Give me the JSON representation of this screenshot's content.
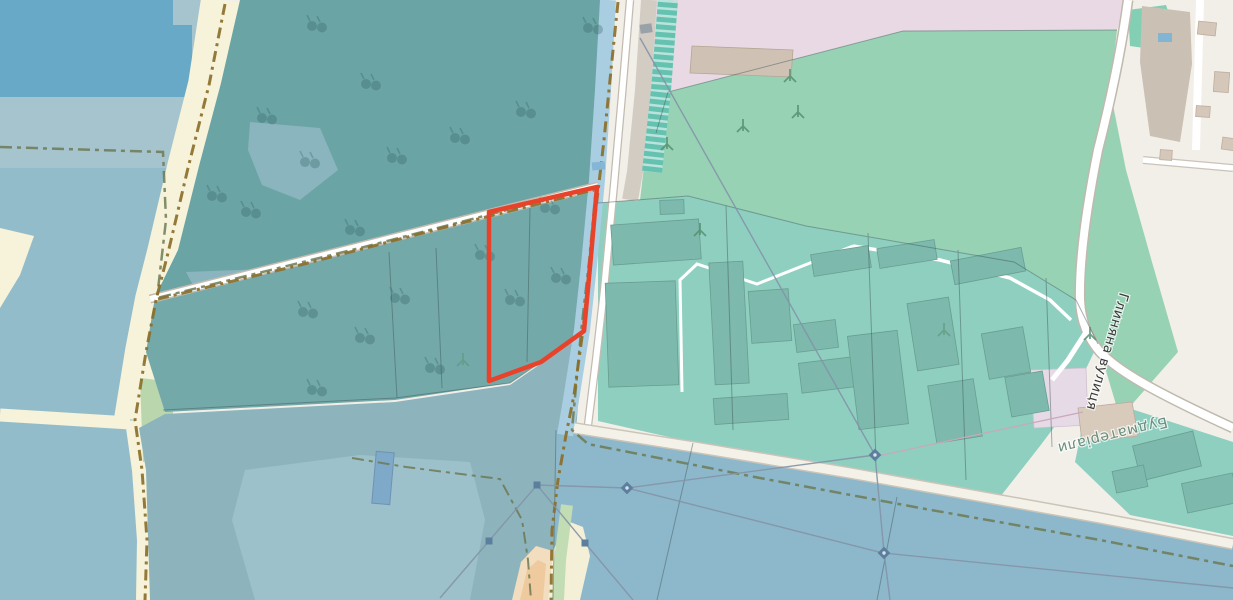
{
  "map": {
    "description": "openstreetmap-style rendering, rotated 180 degrees, with selected land parcel highlighted",
    "labels": {
      "street": "Глиняна вулиця",
      "landuse": "Будматеріали"
    },
    "colors": {
      "background": "#f2efe9",
      "water_dark": "#67a9c7",
      "water": "#93bcca",
      "water_band": "#a6c4ce",
      "water_bottom": "#8db8cb",
      "stream": "#a9cee1",
      "farmland": "#f6f3da",
      "forest": "#6ba4a4",
      "forest_parcels": "#74a9a9",
      "meadow_teal": "#8db4bd",
      "grass": "#97d2b4",
      "industrial_teal": "#8ecfc0",
      "building_teal": "#7db9ac",
      "building_gray": "#cfc2b4",
      "industrial_pink": "#e9d9e5",
      "brownfield": "#cbc0b4",
      "road_fill": "#ffffff",
      "road_casing": "#c2bcb0",
      "track": "#8a6d28",
      "boundary": "#6d7a55",
      "selection": "#e8432a",
      "sand": "#f2ddbe",
      "pale_green": "#b9d6ad",
      "street_label": "#3b3b3b",
      "landuse_label": "#6a8f7d"
    },
    "icons": {
      "orchard": "orchard-icon",
      "tree": "tree-icon",
      "pylon": "power-pylon-icon",
      "barrier": "barrier-icon"
    }
  }
}
